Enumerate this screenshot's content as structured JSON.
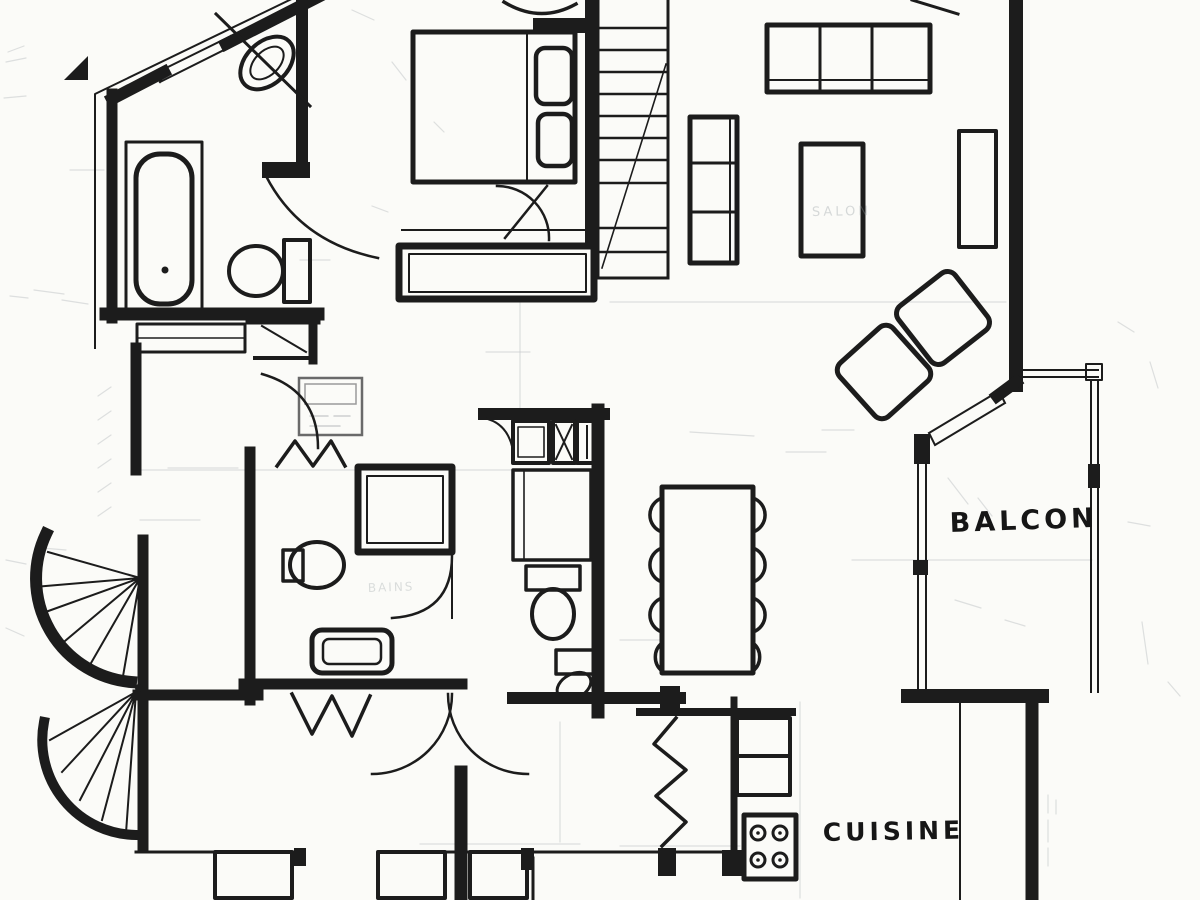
{
  "labels": {
    "balcony": "BALCON",
    "kitchen": "CUISINE",
    "living_room_pencil": "SALON",
    "bathroom_pencil": "BAINS"
  },
  "colors": {
    "ink": "#1c1c1c",
    "paper": "#fbfbf8",
    "pencil": "#a9adb0"
  }
}
